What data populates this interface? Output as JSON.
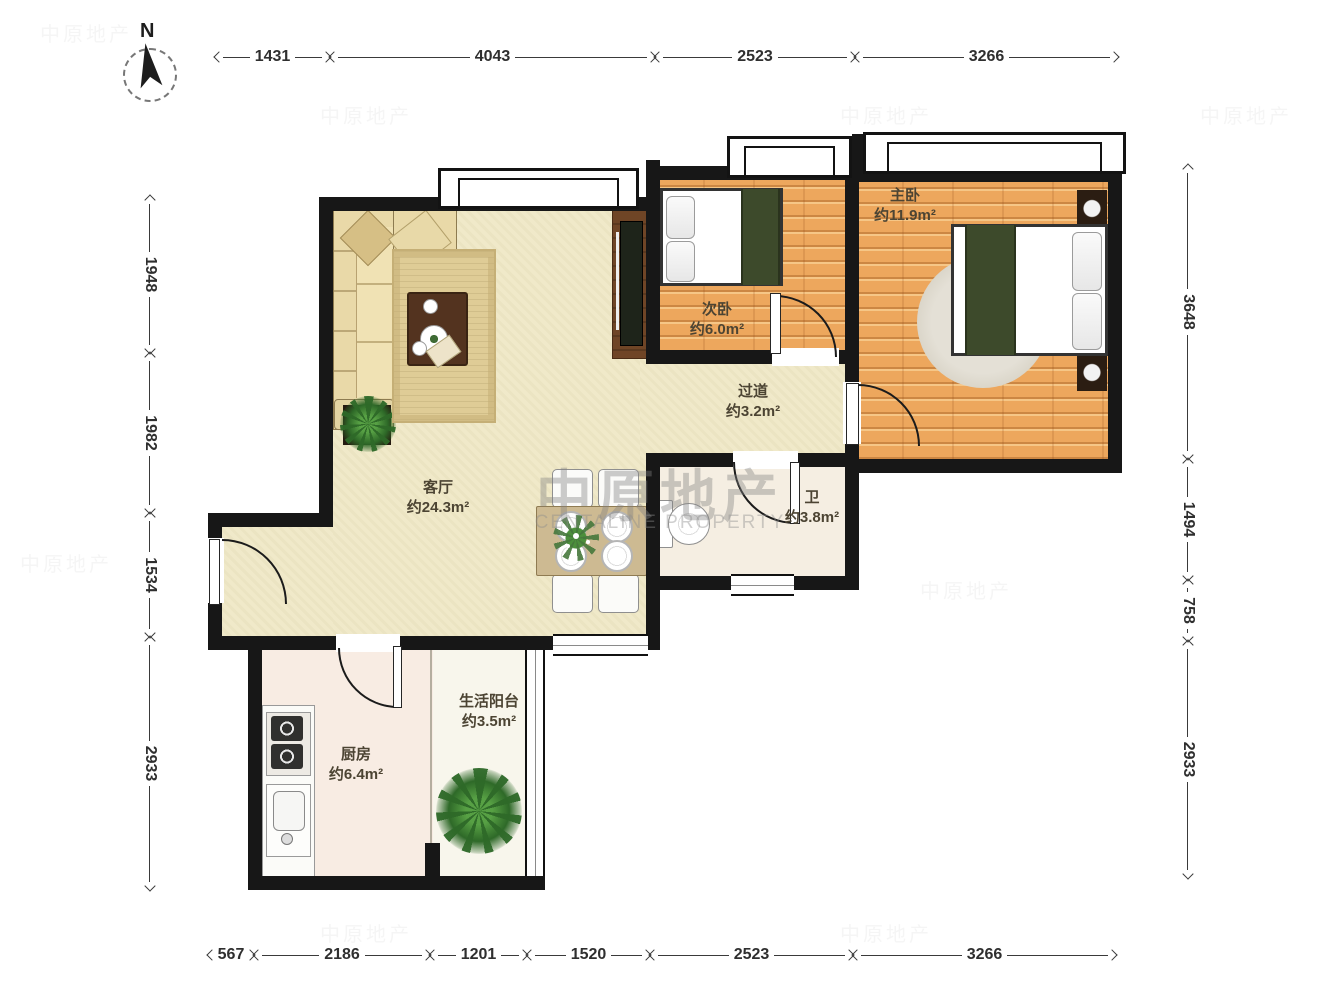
{
  "north": {
    "label": "N",
    "icon": "north-arrow"
  },
  "watermark": {
    "cn": "中原地产",
    "en": "CENTALINE PROPERTY"
  },
  "rooms": {
    "master": {
      "name": "主卧",
      "area": "约11.9m²"
    },
    "second": {
      "name": "次卧",
      "area": "约6.0m²"
    },
    "hallway": {
      "name": "过道",
      "area": "约3.2m²"
    },
    "living": {
      "name": "客厅",
      "area": "约24.3m²"
    },
    "bath": {
      "name": "卫",
      "area": "约3.8m²"
    },
    "kitchen": {
      "name": "厨房",
      "area": "约6.4m²"
    },
    "balcony": {
      "name": "生活阳台",
      "area": "约3.5m²"
    }
  },
  "dimensions": {
    "top": [
      "1431",
      "4043",
      "2523",
      "3266"
    ],
    "bottom": [
      "567",
      "2186",
      "1201",
      "1520",
      "2523",
      "3266"
    ],
    "left": [
      "1948",
      "1982",
      "1534",
      "2933"
    ],
    "right": [
      "3648",
      "1494",
      "758",
      "2933"
    ]
  },
  "colors": {
    "wall": "#171717",
    "wood_floor": "#EDA75D",
    "living_floor": "#F0E9C9",
    "kitchen_floor": "#F8ECE3",
    "bath_floor": "#F5EEE2",
    "balcony_floor": "#F8F6EC",
    "blanket_green": "#3D4A2B",
    "furniture_brown": "#53331F",
    "dim_line": "#3a3a3a",
    "label_text": "#4c4433"
  }
}
